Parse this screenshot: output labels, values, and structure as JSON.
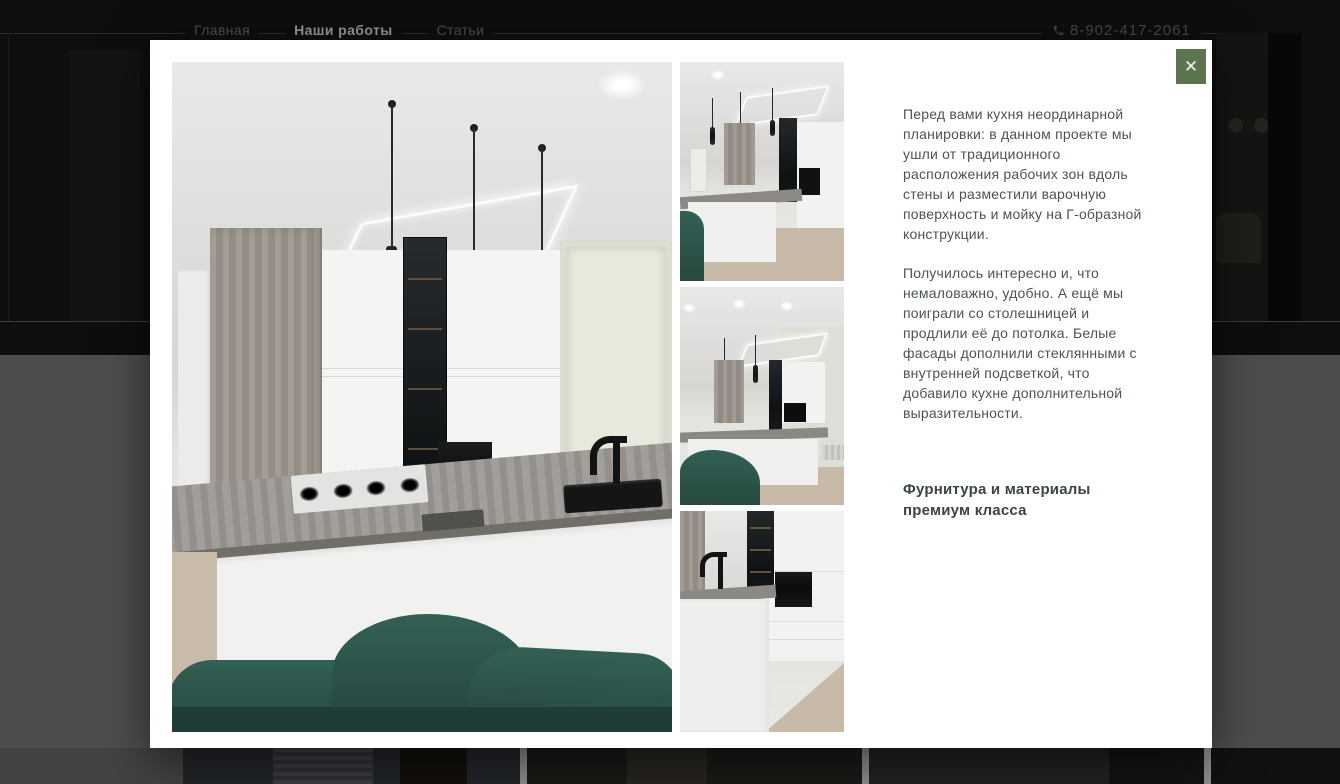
{
  "page": {
    "nav": {
      "items": [
        {
          "label": "Главная",
          "active": false
        },
        {
          "label": "Наши работы",
          "active": true
        },
        {
          "label": "Статьи",
          "active": false
        }
      ],
      "phone": "8-902-417-2061"
    }
  },
  "modal": {
    "close_icon": "✕",
    "gallery": {
      "main_photo": "kitchen-main-view",
      "thumbnails": [
        "kitchen-angle-view",
        "kitchen-front-view",
        "kitchen-island-closeup"
      ]
    },
    "description": {
      "paragraphs": [
        "Перед вами кухня неординарной планировки: в данном проекте мы ушли от традиционного расположения рабочих зон вдоль стены и разместили варочную поверхность и мойку на Г-образной конструкции.",
        "Получилось интересно и, что немаловажно, удобно. А ещё мы поиграли со столешницей и продлили её до потолка. Белые фасады дополнили стеклянными с внутренней подсветкой, что добавило кухне дополнительной выразительности."
      ],
      "heading": "Фурнитура и материалы премиум класса"
    }
  },
  "colors": {
    "accent_green": "#5d7450",
    "modal_bg": "#ffffff",
    "body_text": "#4b5452",
    "dim_overlay": "#4d4d4d",
    "sofa_teal": "#2b5048"
  }
}
